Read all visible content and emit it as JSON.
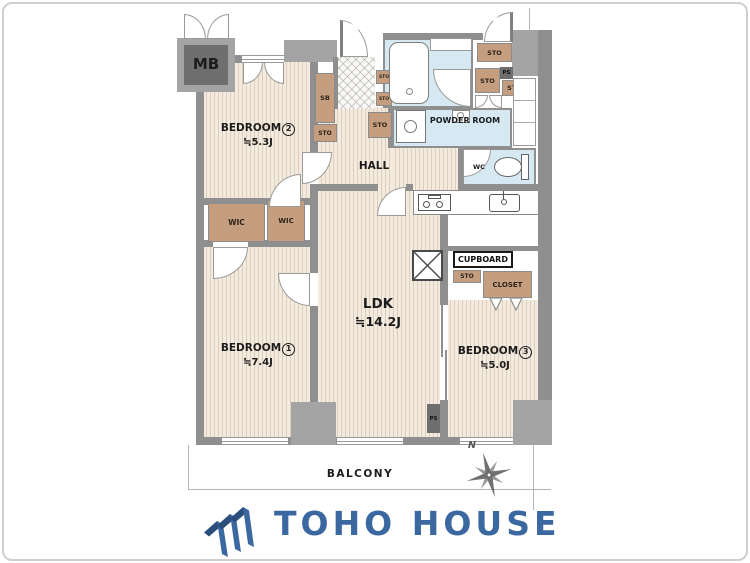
{
  "rooms": {
    "mb": {
      "label": "MB"
    },
    "bedroom2": {
      "label": "BEDROOM",
      "number": "2",
      "size": "≒5.3J"
    },
    "bedroom1": {
      "label": "BEDROOM",
      "number": "1",
      "size": "≒7.4J"
    },
    "bedroom3": {
      "label": "BEDROOM",
      "number": "3",
      "size": "≒5.0J"
    },
    "ldk": {
      "label": "LDK",
      "size": "≒14.2J"
    },
    "hall": {
      "label": "HALL"
    },
    "powder": {
      "label": "POWDER ROOM"
    },
    "wc": {
      "label": "WC"
    },
    "balcony": {
      "label": "BALCONY"
    }
  },
  "storage": {
    "wic": "WIC",
    "sb": "SB",
    "sto": "STO",
    "ps": "PS",
    "cupboard": "CUPBOARD",
    "closet": "CLOSET"
  },
  "compass": {
    "north": "N"
  },
  "logo": {
    "text": "TOHO HOUSE"
  },
  "colors": {
    "wall_gray": "#8f8f8f",
    "floor_beige": "#f3ebdf",
    "floor_stripe": "#decdb8",
    "wet_area_blue": "#d6e9f3",
    "storage_brown": "#c59e80",
    "logo_blue": "#3c68a2"
  }
}
